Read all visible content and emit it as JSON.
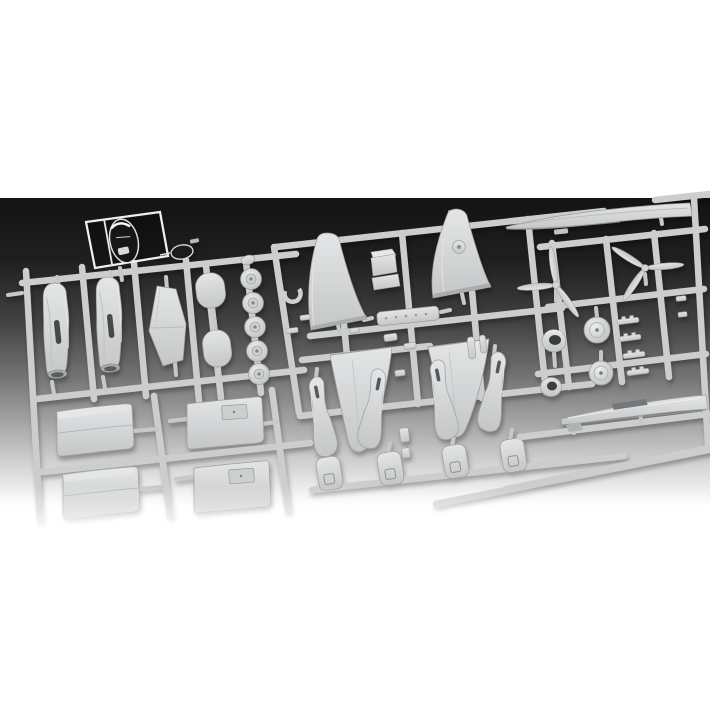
{
  "scene": {
    "description": "Product photograph of light grey injection-moulded plastic model aircraft kit sprues lying on a studio background that grades from near-black at the top to white at the bottom",
    "subject": "plastic model kit sprues with aircraft parts",
    "background": {
      "page": "#ffffff",
      "top": "#131313",
      "upper_mid": "#1f1f1f",
      "mid": "#757575",
      "lower_mid": "#d0d0d0",
      "bottom": "#ffffff"
    },
    "colors": {
      "plastic_light": "#e4e5e6",
      "plastic": "#c4c6c7",
      "plastic_shadow": "#9a9d9e",
      "runner": "#cbcdcf",
      "runner_highlight": "#e9eaeb",
      "clear_part_edge": "#eef0f2",
      "clear_part_body": "#161617",
      "slot_dark": "#46484a"
    },
    "parts": [
      {
        "id": "clear-canopy-sprue",
        "label": "transparent canopy sprue",
        "count": 1
      },
      {
        "id": "nacelle-half",
        "label": "engine nacelle / fuselage half",
        "count": 2
      },
      {
        "id": "tail-cone",
        "label": "tapered tail cone part",
        "count": 1
      },
      {
        "id": "oval-hatch",
        "label": "oval hatch part",
        "count": 2
      },
      {
        "id": "main-wheel",
        "label": "main wheel",
        "count": 5
      },
      {
        "id": "upper-wing-half",
        "label": "upper wing half",
        "count": 2
      },
      {
        "id": "lower-wing-half",
        "label": "lower wing half",
        "count": 2
      },
      {
        "id": "propeller",
        "label": "three-blade propeller",
        "count": 2
      },
      {
        "id": "long-fuselage-half",
        "label": "long pointed fuselage half",
        "count": 2
      },
      {
        "id": "cowl-ring",
        "label": "engine cowl ring",
        "count": 2
      },
      {
        "id": "wheel-disc",
        "label": "wheel disc / backplate",
        "count": 2
      },
      {
        "id": "cowl-panel",
        "label": "curved cowling panel",
        "count": 4
      },
      {
        "id": "gear-strut",
        "label": "curved nacelle strut",
        "count": 4
      },
      {
        "id": "gear-door",
        "label": "landing gear door",
        "count": 4
      },
      {
        "id": "small-parts",
        "label": "assorted small detail parts",
        "count": 20
      }
    ]
  }
}
